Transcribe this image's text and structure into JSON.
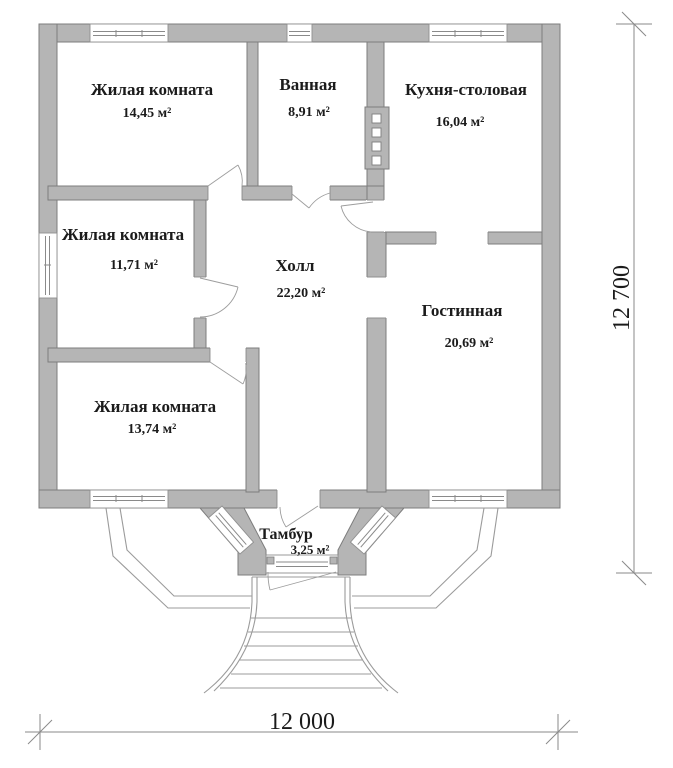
{
  "colors": {
    "wall_fill": "#b5b5b5",
    "wall_stroke": "#7d7d7d",
    "text": "#1b1b1b"
  },
  "rooms": [
    {
      "id": "living-room-1",
      "name": "Жилая комната",
      "area": "14,45 м²"
    },
    {
      "id": "bathroom",
      "name": "Ванная",
      "area": "8,91 м²"
    },
    {
      "id": "kitchen-dining",
      "name": "Кухня-столовая",
      "area": "16,04 м²"
    },
    {
      "id": "living-room-2",
      "name": "Жилая комната",
      "area": "11,71 м²"
    },
    {
      "id": "hall",
      "name": "Холл",
      "area": "22,20 м²"
    },
    {
      "id": "lounge",
      "name": "Гостинная",
      "area": "20,69 м²"
    },
    {
      "id": "living-room-3",
      "name": "Жилая комната",
      "area": "13,74 м²"
    },
    {
      "id": "tambour",
      "name": "Тамбур",
      "area": "3,25 м²"
    }
  ],
  "dimensions": {
    "width_label": "12 000",
    "height_label": "12 700"
  }
}
